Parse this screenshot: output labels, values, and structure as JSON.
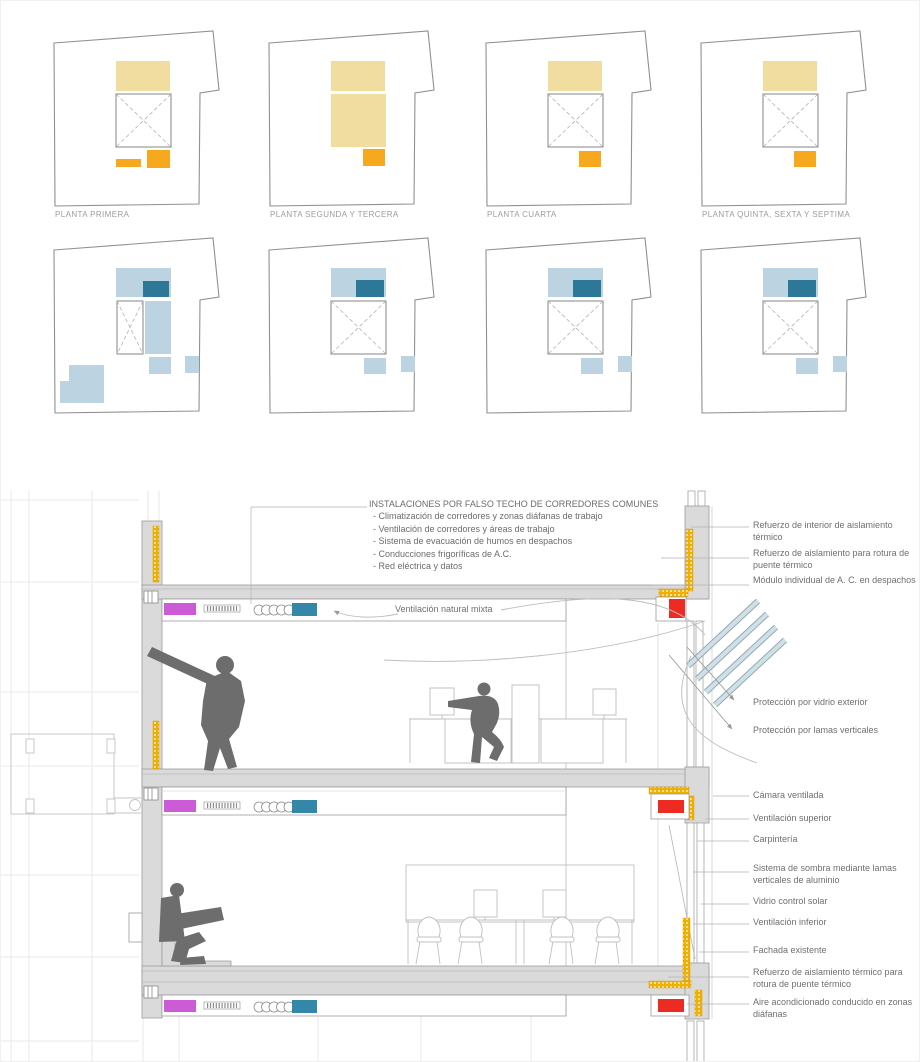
{
  "palette": {
    "plan_yellow_light": "#f2dda0",
    "plan_orange": "#f6a91e",
    "plan_blue_light": "#bcd4e2",
    "plan_blue_dark": "#2e7897",
    "duct_magenta": "#cb5cd6",
    "duct_teal": "#3387a9",
    "ac_red": "#ee2b22",
    "insulation_yellow": "#f1b000",
    "slab_gray": "#dadada",
    "figure_gray": "#6d6d6d"
  },
  "plans": {
    "labels": [
      "PLANTA PRIMERA",
      "PLANTA SEGUNDA Y TERCERA",
      "PLANTA CUARTA",
      "PLANTA QUINTA, SEXTA Y SEPTIMA"
    ]
  },
  "section": {
    "installations_title": "INSTALACIONES POR FALSO TECHO DE CORREDORES COMUNES",
    "installations_items": [
      "- Climatización de corredores y zonas diáfanas de trabajo",
      "- Ventilación de corredores y áreas de trabajo",
      "- Sistema de evacuación de humos en despachos",
      "- Conducciones frigoríficas de A.C.",
      "- Red eléctrica y datos"
    ],
    "ventilation_label": "Ventilación natural mixta",
    "right_labels": [
      "Refuerzo de interior de aislamiento térmico",
      "Refuerzo de aislamiento para rotura de puente térmico",
      "Módulo individual de A. C. en despachos",
      "Protección por vidrio exterior",
      "Protección por lamas verticales",
      "Cámara ventilada",
      "Ventilación superior",
      "Carpintería",
      "Sistema de sombra mediante lamas verticales de aluminio",
      "Vidrio control solar",
      "Ventilación inferior",
      "Fachada existente",
      "Refuerzo de aislamiento térmico para rotura de puente térmico",
      "Aire acondicionado conducido en zonas diáfanas"
    ]
  }
}
